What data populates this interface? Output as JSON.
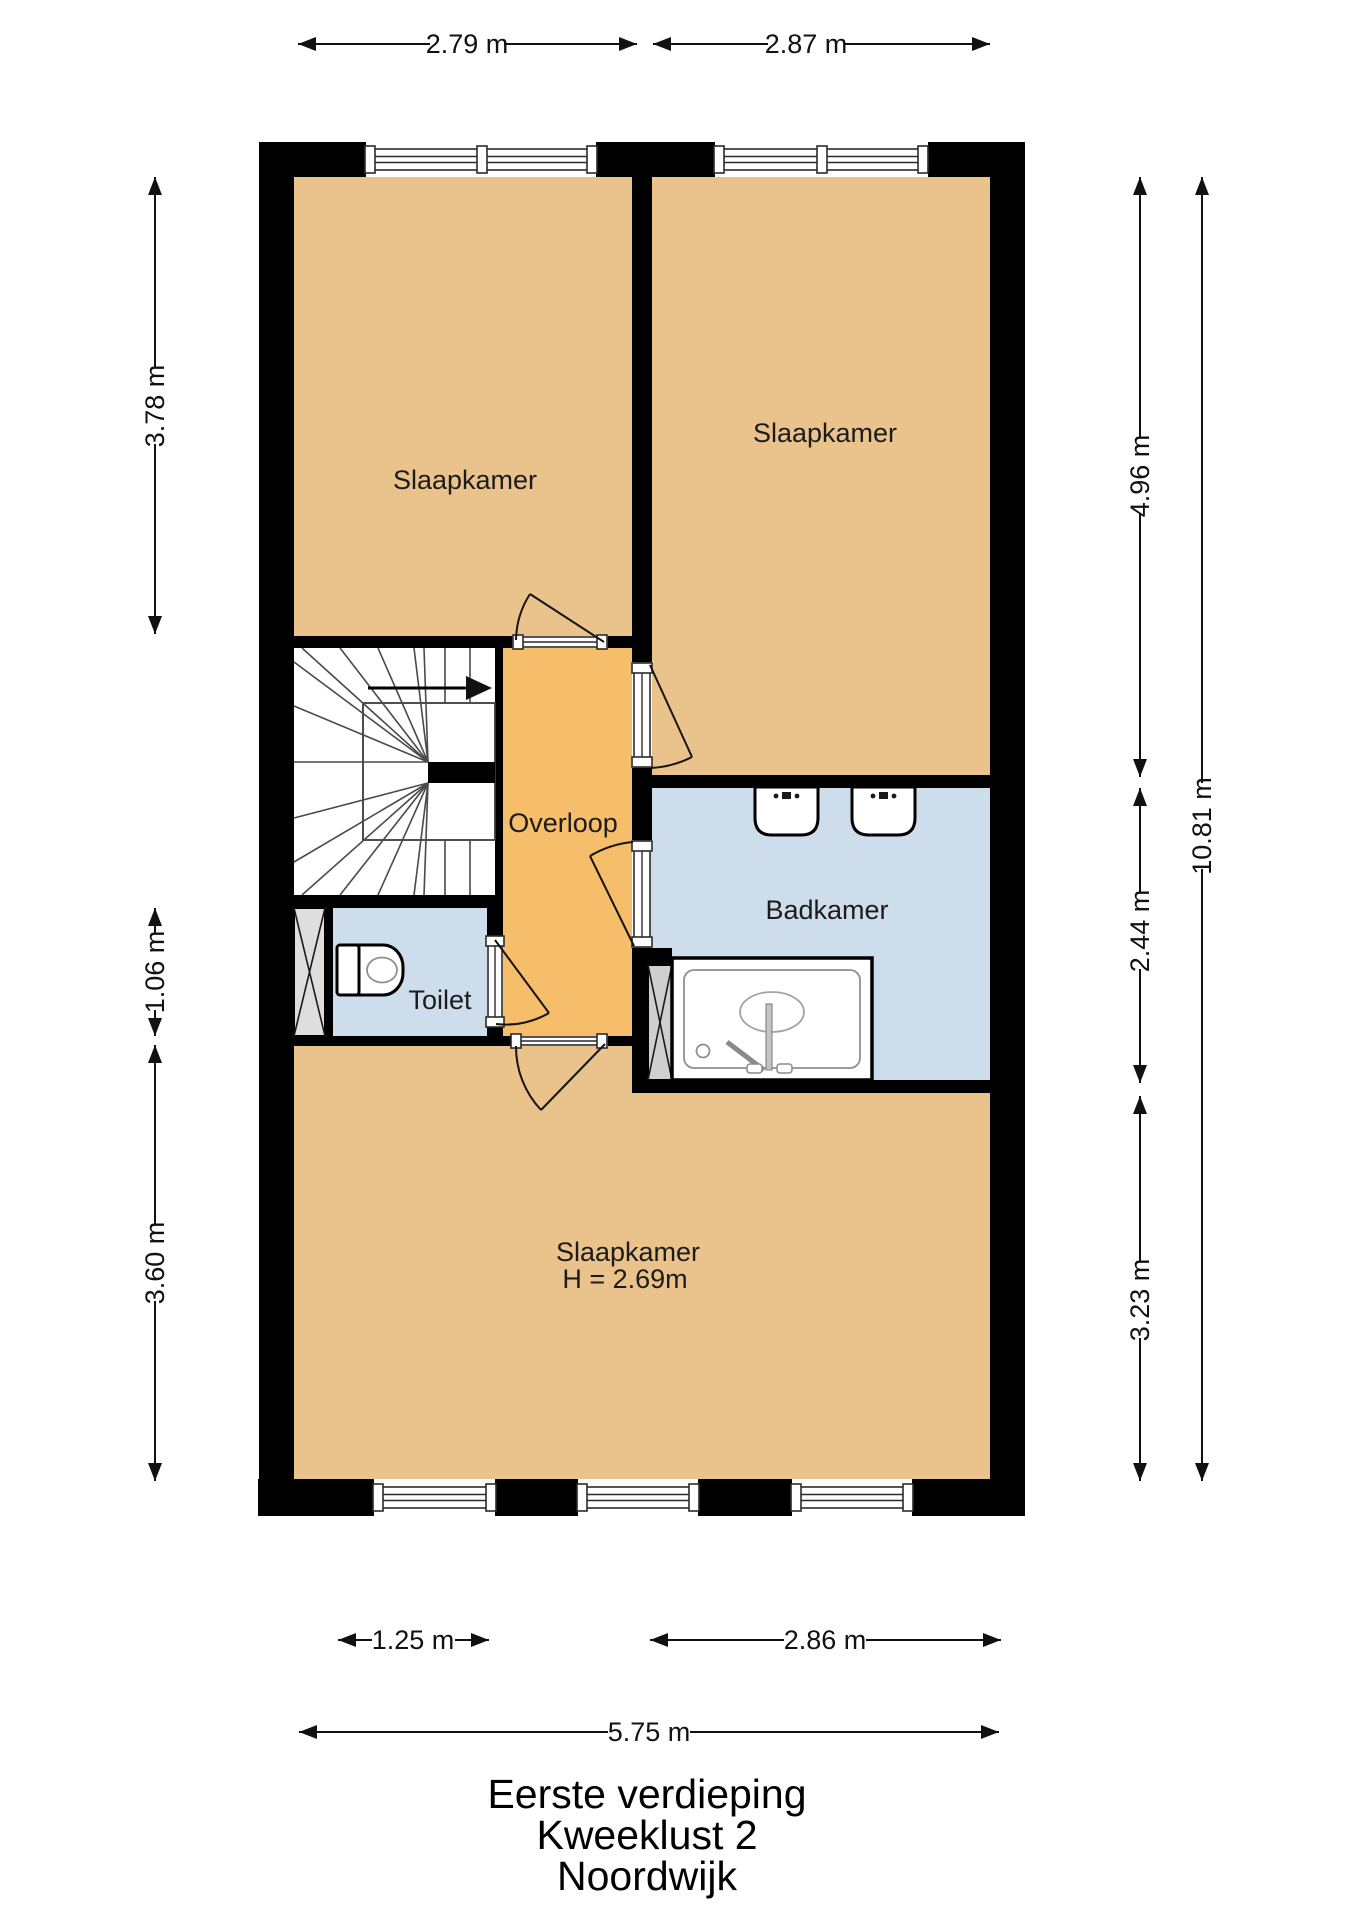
{
  "title": {
    "line1": "Eerste verdieping",
    "line2": "Kweeklust 2",
    "line3": "Noordwijk"
  },
  "rooms": {
    "bedroom_top_left": "Slaapkamer",
    "bedroom_top_right": "Slaapkamer",
    "landing": "Overloop",
    "bathroom": "Badkamer",
    "toilet": "Toilet",
    "bedroom_bottom": "Slaapkamer",
    "bedroom_bottom_height": "H = 2.69m"
  },
  "dimensions": {
    "top_left_width": "2.79 m",
    "top_right_width": "2.87 m",
    "left_upper": "3.78 m",
    "left_middle": "1.06 m",
    "left_lower": "3.60 m",
    "right_upper": "4.96 m",
    "right_middle": "2.44 m",
    "right_lower": "3.23 m",
    "right_total": "10.81 m",
    "bottom_left": "1.25 m",
    "bottom_right": "2.86 m",
    "bottom_total": "5.75 m"
  },
  "colors": {
    "room_fill": "#EAC28B",
    "landing_fill": "#F6BD6B",
    "wet_room_fill": "#CEDDEB",
    "wall_color": "#000000",
    "shaft_fill": "#DEDEDE",
    "background": "#FFFFFF"
  },
  "fixtures": {
    "stairs": "winder-staircase",
    "toilet": "toilet",
    "sinks": "two-washbasins",
    "shower": "shower-tray"
  }
}
